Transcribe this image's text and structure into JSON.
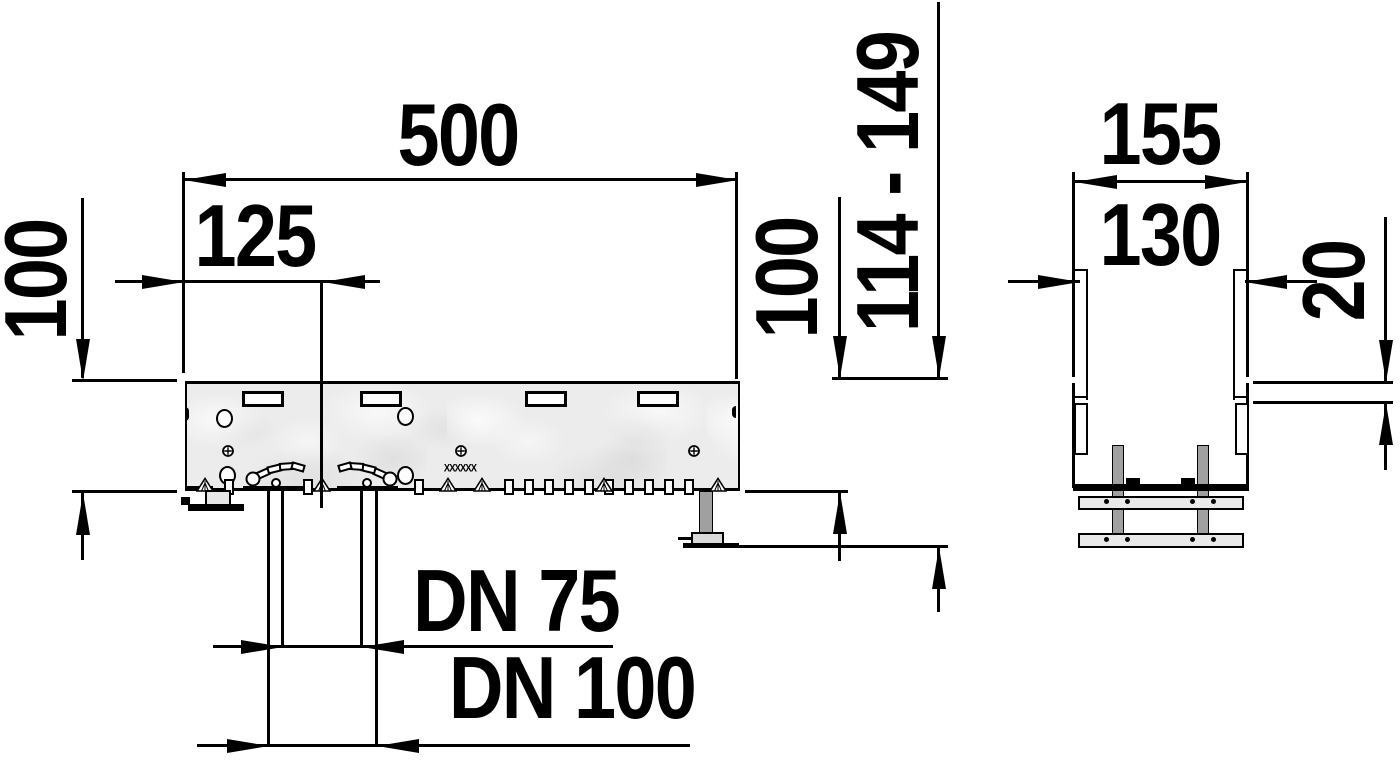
{
  "drawing": {
    "side_view": {
      "length": "500",
      "outlet_offset": "125",
      "height_left": "100",
      "height_right": "100",
      "total_height_range": "114 - 149",
      "outlet_small": "DN 75",
      "outlet_large": "DN 100",
      "marking": "XXXXXX"
    },
    "section_view": {
      "outer_width": "155",
      "inner_width": "130",
      "adjustment": "20"
    },
    "colors": {
      "line": "#000000",
      "background": "#ffffff",
      "body_fill": "#ececec",
      "metal": "#a0a0a0"
    }
  }
}
